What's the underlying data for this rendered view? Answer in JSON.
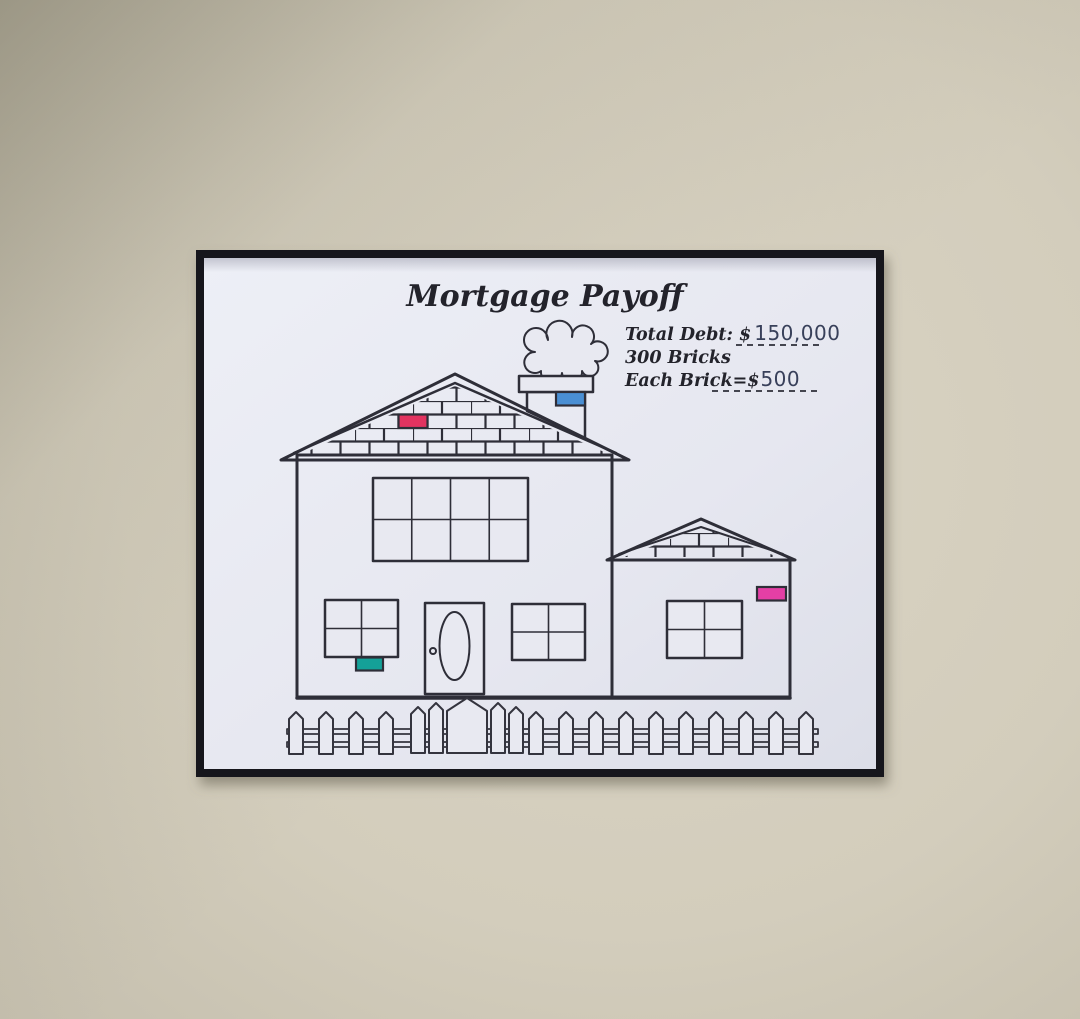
{
  "poster": {
    "title": "Mortgage Payoff",
    "info": {
      "total_debt_label": "Total Debt: $",
      "total_debt_value": "150,000",
      "bricks_line": "300 Bricks",
      "each_brick_label": "Each Brick=$",
      "each_brick_value": "500"
    },
    "colors": {
      "ink": "#2e2e38",
      "paper": "#e8e9f1",
      "frame": "#17171c",
      "wall": "#d3cdbc"
    },
    "colored_bricks": [
      {
        "name": "gable-pink-brick",
        "x": 398.5,
        "y": 414.5,
        "w": 29,
        "h": 13.5,
        "color": "#e23360"
      },
      {
        "name": "chimney-blue-brick",
        "x": 556,
        "y": 392,
        "w": 29,
        "h": 13.5,
        "color": "#4a8fd3"
      },
      {
        "name": "window-teal-brick",
        "x": 356,
        "y": 657.5,
        "w": 27,
        "h": 13,
        "color": "#14a198"
      },
      {
        "name": "extension-pink-brick",
        "x": 757,
        "y": 587,
        "w": 29,
        "h": 13.5,
        "color": "#e43fa5"
      }
    ]
  }
}
